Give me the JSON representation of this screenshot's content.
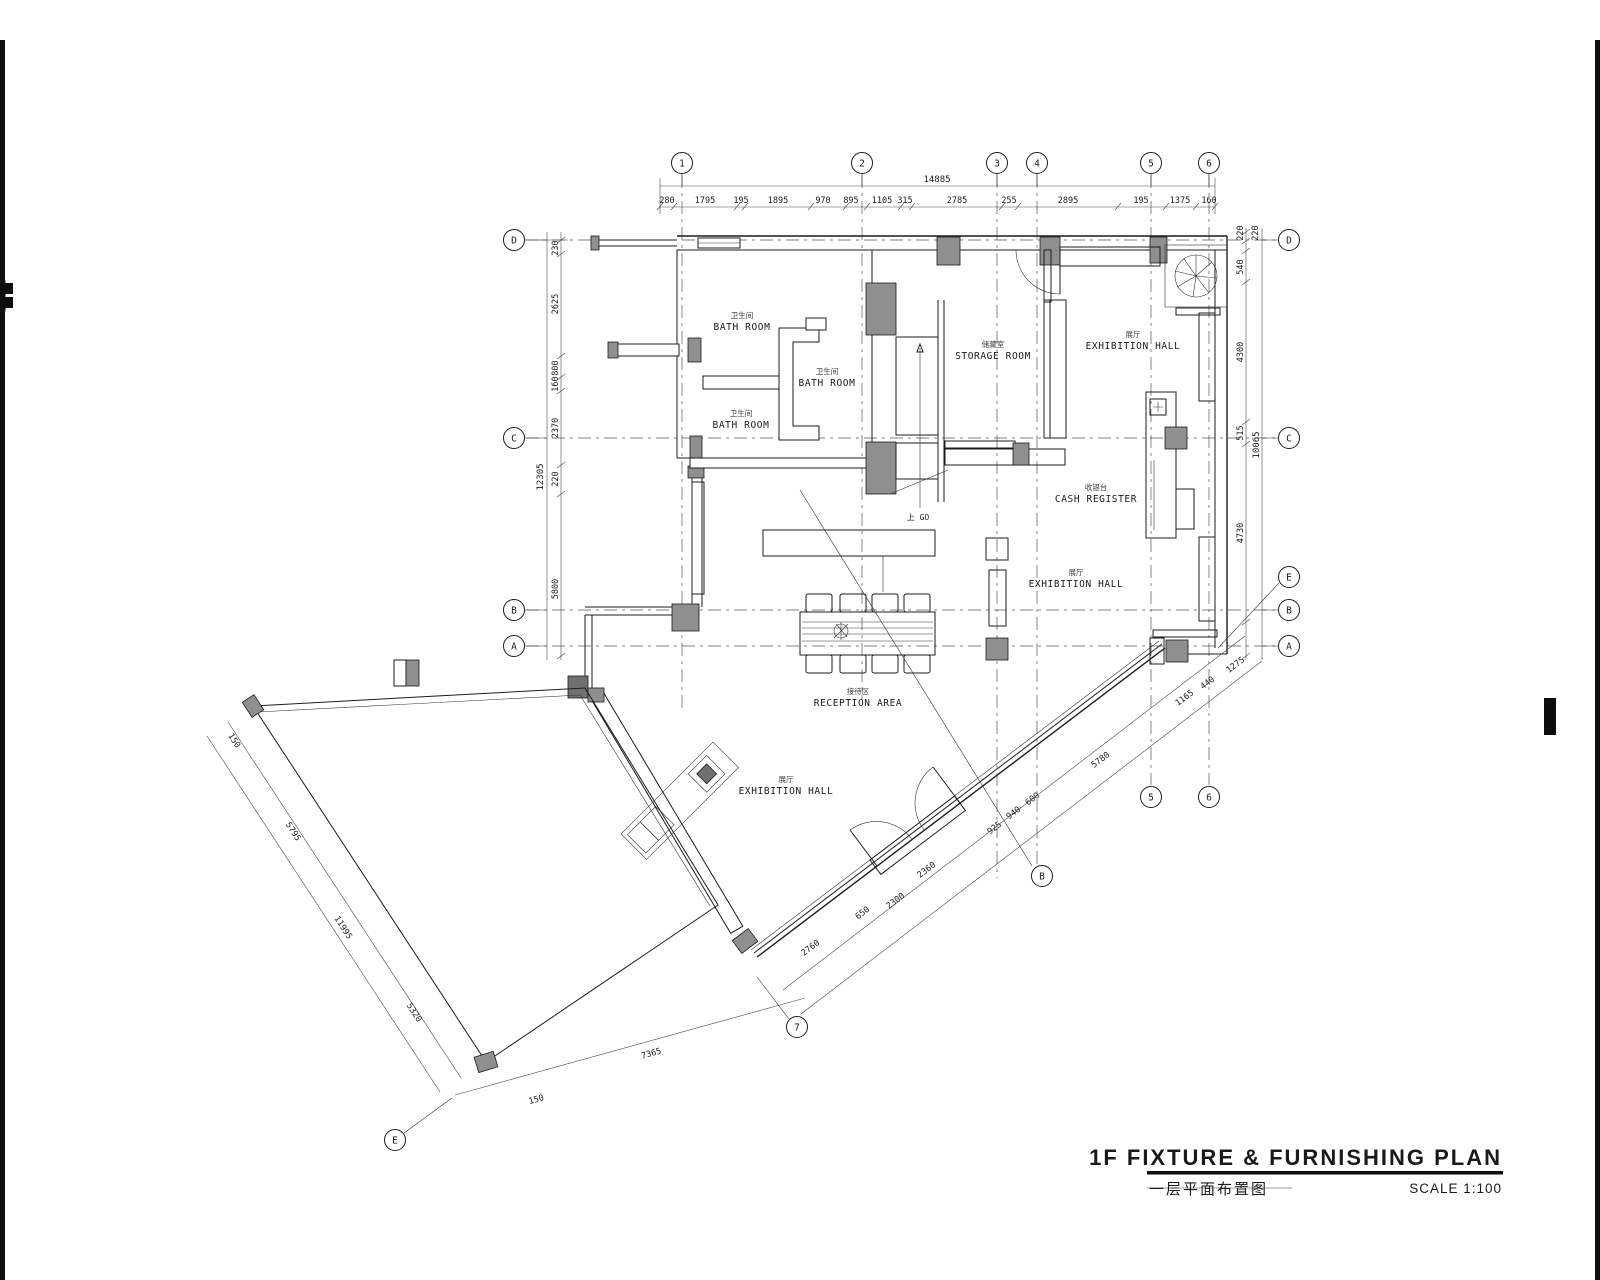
{
  "title_block": {
    "title": "1F  FIXTURE  &  FURNISHING  PLAN",
    "title_zh": "一层平面布置图",
    "scale": "SCALE 1:100"
  },
  "grid": {
    "top": [
      "1",
      "2",
      "3",
      "4",
      "5",
      "6"
    ],
    "left": [
      "D",
      "C",
      "B",
      "A"
    ],
    "right": [
      "D",
      "C",
      "E",
      "B",
      "A"
    ],
    "bottom": [
      "5",
      "6",
      "B",
      "7",
      "E"
    ]
  },
  "rooms": {
    "bath": {
      "en": "BATH ROOM",
      "zh": "卫生间"
    },
    "storage": {
      "en": "STORAGE ROOM",
      "zh": "储藏室"
    },
    "exhibition": {
      "en": "EXHIBITION HALL",
      "zh": "展厅"
    },
    "cash": {
      "en": "CASH REGISTER",
      "zh": "收银台"
    },
    "reception": {
      "en": "RECEPTION AREA",
      "zh": "接待区"
    },
    "stair_note": "上 GO"
  },
  "dims": {
    "top": {
      "overall": "14885",
      "segments": [
        "280",
        "1795",
        "195",
        "1895",
        "970",
        "895",
        "1105",
        "315",
        "2785",
        "255",
        "2895",
        "195",
        "1375",
        "160"
      ]
    },
    "left": {
      "overall": "12305",
      "segments": [
        "230",
        "2625",
        "800",
        "160",
        "2370",
        "220",
        "5800"
      ]
    },
    "right": {
      "overall": "10065",
      "segments": [
        "220",
        "220",
        "540",
        "4300",
        "515",
        "4730"
      ]
    },
    "diag_upper": [
      "5780",
      "1165",
      "440",
      "1275"
    ],
    "diag_lower": [
      "2760",
      "650",
      "2300",
      "2360",
      "925",
      "940",
      "600"
    ],
    "terrace": [
      "150",
      "5795",
      "11995",
      "5320"
    ],
    "bottom": [
      "7365",
      "150"
    ]
  }
}
